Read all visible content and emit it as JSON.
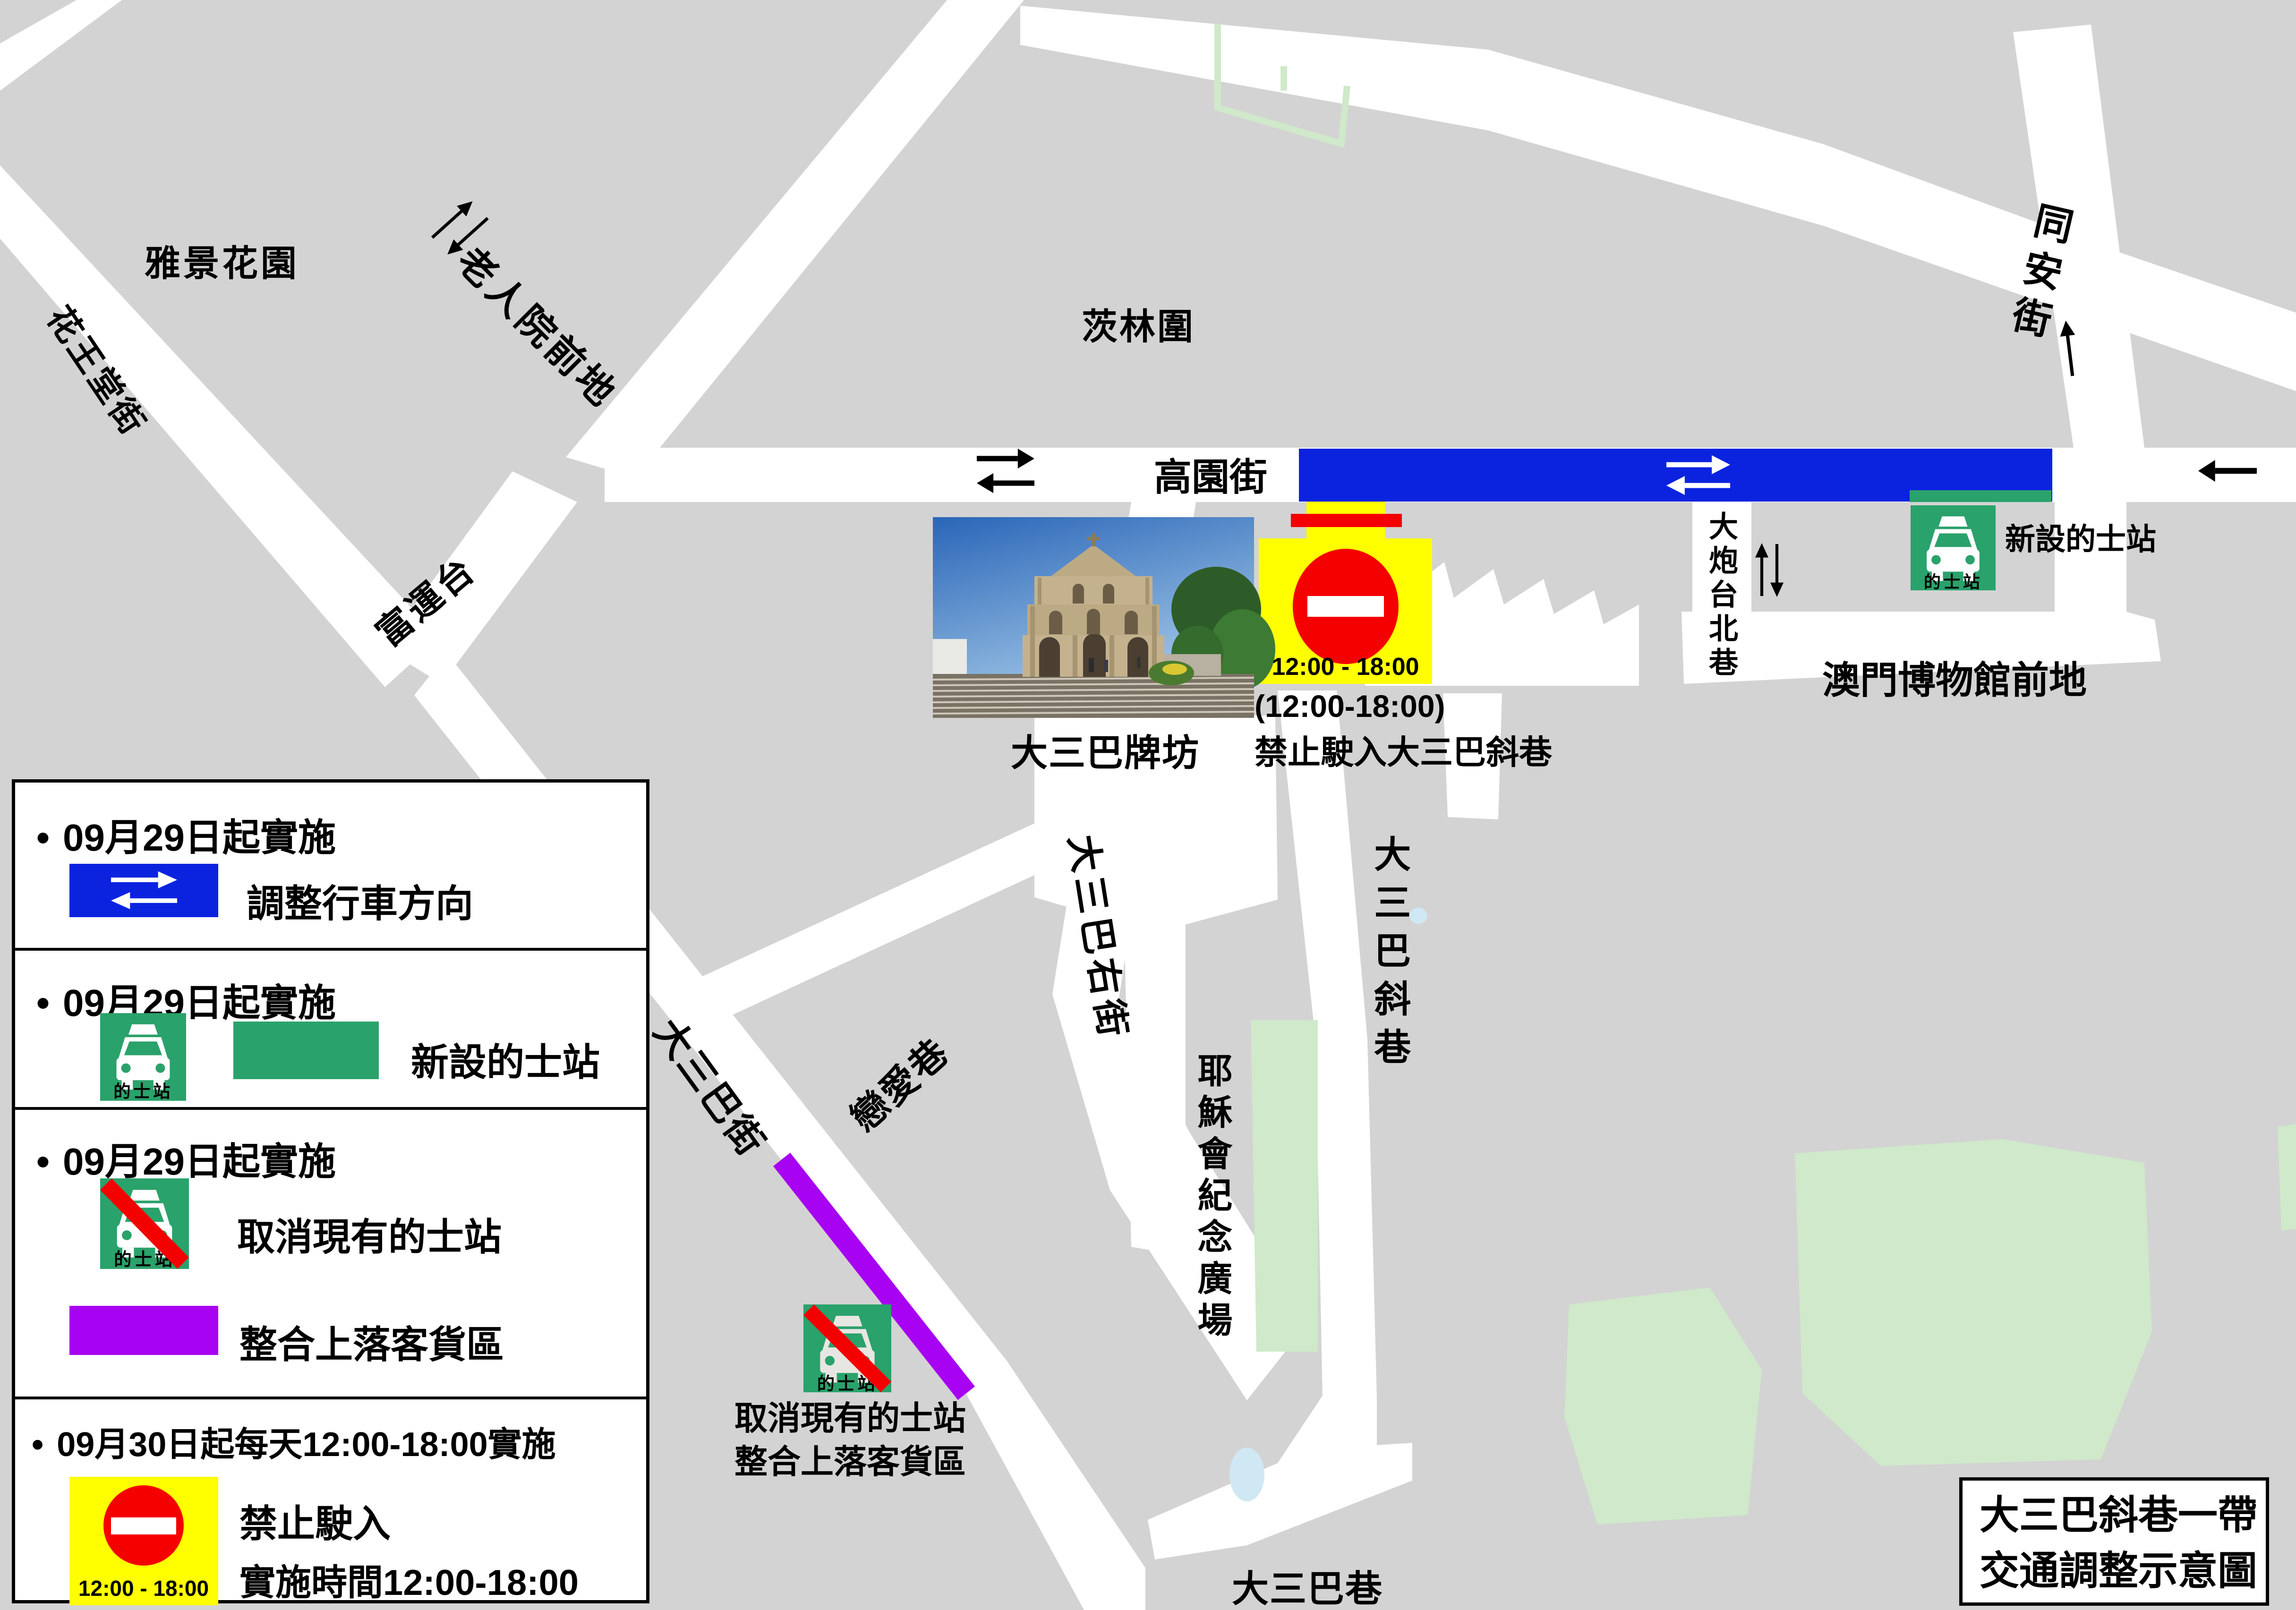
{
  "colors": {
    "bg": "#d3d3d3",
    "road": "#ffffff",
    "ink": "#000000",
    "blue": "#0b23df",
    "green": "#2aa26b",
    "light-green": "#cfe9ca",
    "purple": "#a702f2",
    "yellow": "#ffff00",
    "red": "#f40000",
    "light-blue": "#cfe8f4"
  },
  "map": {
    "taxi_sign_label": "的士站",
    "labels": {
      "yajing_garden": "雅景花園",
      "huawangtang_street": "花王堂街",
      "laorenyuan_qiandi": "老人院前地",
      "fuyuntai": "富運台",
      "cilin_wei": "茨林圍",
      "gaoyuan_street": "高園街",
      "tongan_street": "同安街",
      "dapaotai_north_lane": "大炮台北巷",
      "museum_square": "澳門博物館前地",
      "new_taxi_station": "新設的士站",
      "ruins_stpaul": "大三巴牌坊",
      "dasanba_right_street": "大三巴右街",
      "lianai_lane": "戀愛巷",
      "dasanba_street": "大三巴街",
      "dasanba_xiexiang": "大三巴斜巷",
      "jesuit_square": "耶穌會紀念廣場",
      "dasanba_lane": "大三巴巷",
      "cancel_taxi_line1": "取消現有的士站",
      "cancel_taxi_line2": "整合上落客貨區",
      "sign_time": "12:00 - 18:00",
      "sign_time_paren": "(12:00-18:00)",
      "sign_no_entry_street": "禁止駛入大三巴斜巷"
    }
  },
  "legend": {
    "bullet": "•",
    "items": [
      {
        "date_line": "09月29日起實施",
        "desc": "調整行車方向"
      },
      {
        "date_line": "09月29日起實施",
        "desc": "新設的士站"
      },
      {
        "date_line": "09月29日起實施",
        "desc": "取消現有的士站",
        "desc2": "整合上落客貨區"
      },
      {
        "date_line": "09月30日起每天12:00-18:00實施",
        "desc": "禁止駛入",
        "desc2": "實施時間12:00-18:00",
        "sign_time": "12:00 - 18:00"
      }
    ]
  },
  "title_box": {
    "line1": "大三巴斜巷一帶",
    "line2": "交通調整示意圖"
  }
}
